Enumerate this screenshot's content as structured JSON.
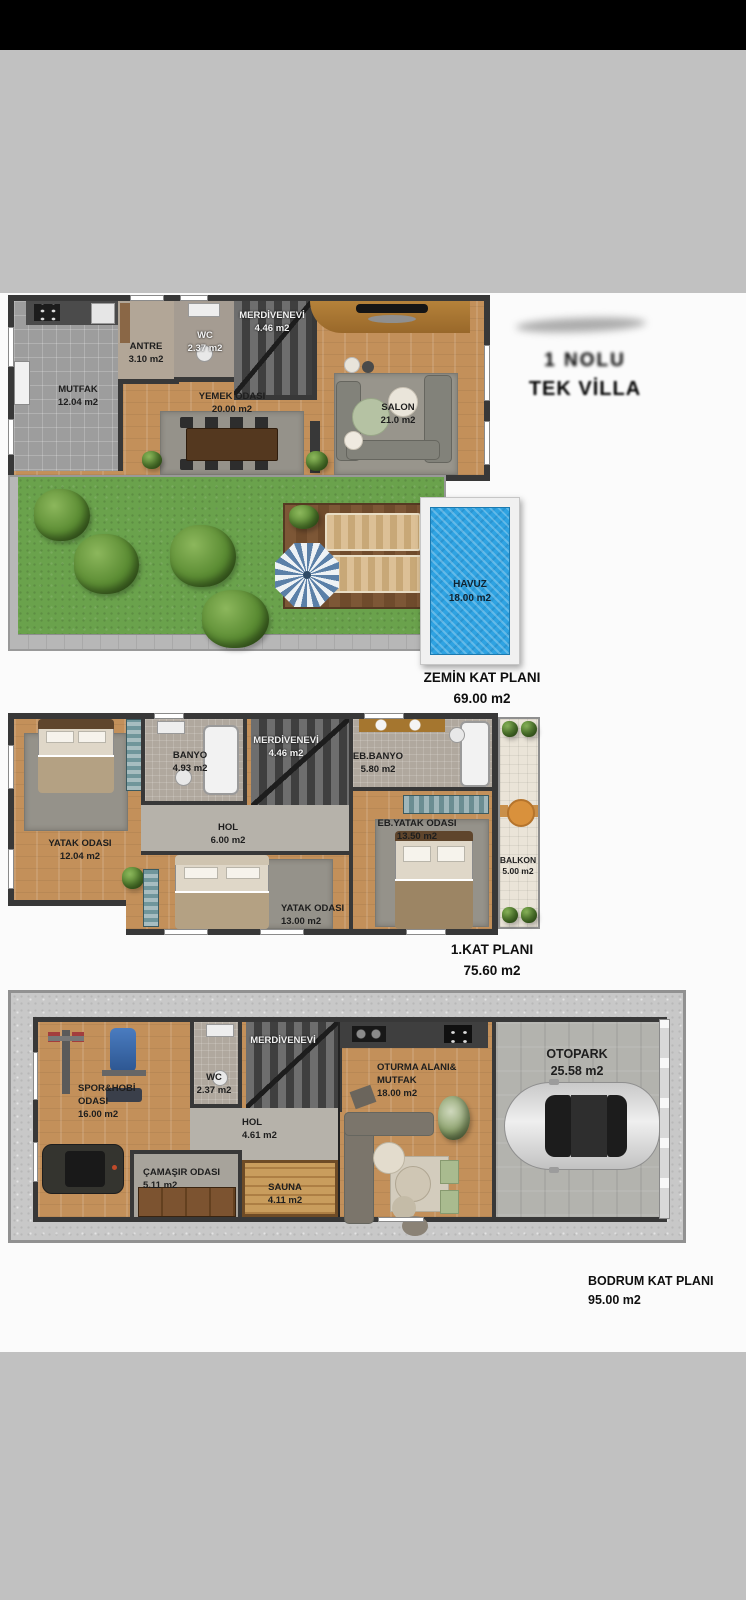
{
  "header": {
    "line1": "1 NOLU",
    "line2": "TEK VİLLA"
  },
  "floors": [
    {
      "title": "ZEMİN KAT PLANI",
      "area": "69.00 m2",
      "rooms": [
        {
          "name": "MUTFAK",
          "area": "12.04 m2"
        },
        {
          "name": "ANTRE",
          "area": "3.10 m2"
        },
        {
          "name": "WC",
          "area": "2.37 m2"
        },
        {
          "name": "MERDİVENEVİ",
          "area": "4.46 m2"
        },
        {
          "name": "YEMEK ODASI",
          "area": "20.00 m2"
        },
        {
          "name": "SALON",
          "area": "21.0 m2"
        },
        {
          "name": "HAVUZ",
          "area": "18.00 m2"
        }
      ]
    },
    {
      "title": "1.KAT PLANI",
      "area": "75.60 m2",
      "rooms": [
        {
          "name": "YATAK ODASI",
          "area": "12.04 m2"
        },
        {
          "name": "BANYO",
          "area": "4.93 m2"
        },
        {
          "name": "MERDİVENEVİ",
          "area": "4.46 m2"
        },
        {
          "name": "EB.BANYO",
          "area": "5.80 m2"
        },
        {
          "name": "HOL",
          "area": "6.00 m2"
        },
        {
          "name": "EB.YATAK ODASI",
          "area": "13.50 m2"
        },
        {
          "name": "YATAK ODASI",
          "area": "13.00 m2"
        },
        {
          "name": "BALKON",
          "area": "5.00 m2"
        }
      ]
    },
    {
      "title": "BODRUM KAT PLANI",
      "area": "95.00 m2",
      "rooms": [
        {
          "name": "SPOR&HOBİ ODASI",
          "area": "16.00 m2"
        },
        {
          "name": "WC",
          "area": "2.37 m2"
        },
        {
          "name": "MERDİVENEVİ",
          "area": ""
        },
        {
          "name": "HOL",
          "area": "4.61 m2"
        },
        {
          "name": "ÇAMAŞIR ODASI",
          "area": "5.11 m2"
        },
        {
          "name": "SAUNA",
          "area": "4.11 m2"
        },
        {
          "name": "OTURMA ALANI& MUTFAK",
          "area": "18.00 m2"
        },
        {
          "name": "OTOPARK",
          "area": "25.58 m2"
        }
      ]
    }
  ],
  "colors": {
    "wall": "#3a3a3a",
    "wood_floor": "#c3905a",
    "grass_green": "#6aa24c",
    "pool_blue": "#2fa3e2",
    "deck_brown": "#7d5736",
    "concrete_gray": "#c8c8c8",
    "page_band_gray": "#c1c1c1",
    "top_bar_black": "#000000"
  }
}
